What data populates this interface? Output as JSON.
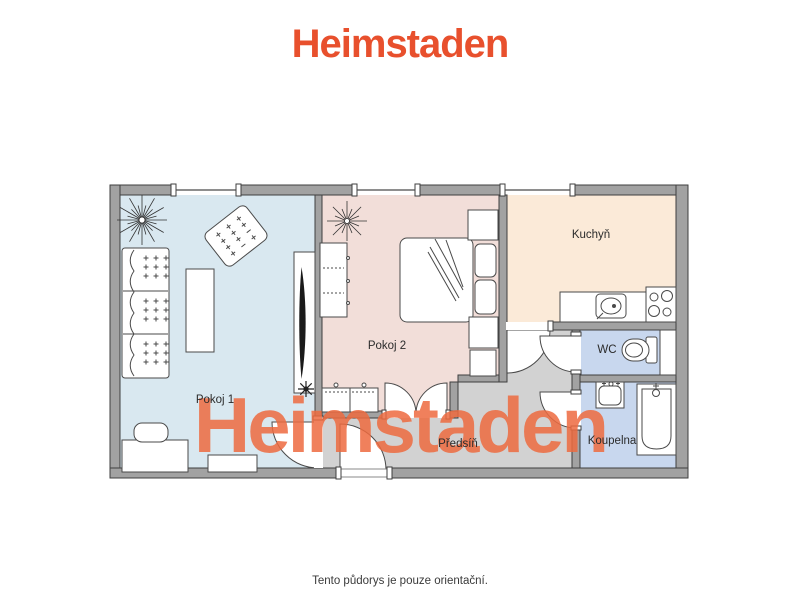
{
  "brand": {
    "logo_text": "Heimstaden",
    "logo_color": "#e8502d",
    "watermark_text": "Heimstaden",
    "watermark_color": "#ee6b40"
  },
  "caption": "Tento půdorys je pouze orientační.",
  "rooms": {
    "pokoj1": {
      "label": "Pokoj 1",
      "color": "#d9e8f0"
    },
    "pokoj2": {
      "label": "Pokoj 2",
      "color": "#f2ded9"
    },
    "kuchyn": {
      "label": "Kuchyň",
      "color": "#fbead8"
    },
    "wc": {
      "label": "WC",
      "color": "#c8d7ee"
    },
    "koupelna": {
      "label": "Koupelna",
      "color": "#c8d7ee"
    },
    "predsin": {
      "label": "Předsíň",
      "color": "#d2d2d2"
    }
  },
  "plan": {
    "wall_color": "#a2a2a2",
    "wall_outline": "#3f3f3f",
    "furniture_outline": "#4a4a4a"
  }
}
